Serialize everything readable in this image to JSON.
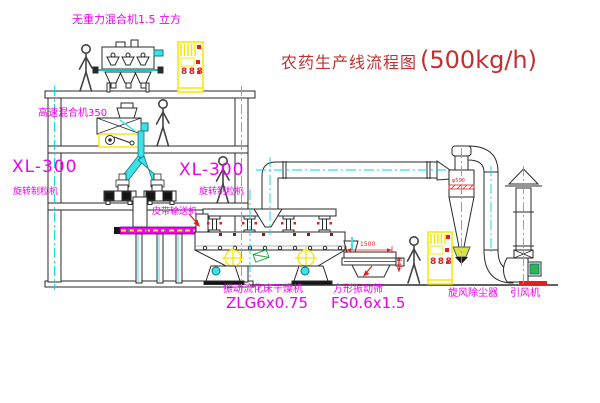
{
  "diagram": {
    "title": "农药生产线流程图",
    "capacity": "(500kg/h)"
  },
  "labels": {
    "gravity_mixer": "无重力混合机1.5 立方",
    "high_speed_mixer": "高速混合机350",
    "granulator_left_model": "XL-300",
    "granulator_left_name": "旋转制粒机",
    "granulator_mid_model": "XL-300",
    "granulator_mid_name": "旋转制粒机",
    "belt_conveyor": "皮带输送机",
    "dryer_name": "振动流化床干燥机",
    "dryer_model": "ZLG6x0.75",
    "sieve_name": "方形振动筛",
    "sieve_model": "FS0.6x1.5",
    "cyclone": "旋风除尘器",
    "fan": "引风机"
  },
  "dimensions": {
    "sieve_width": "1500",
    "sieve_height": "545",
    "cyclone_diameter": "φ500"
  },
  "cabinets": {
    "left_display": "888",
    "right_display": "888"
  },
  "colors": {
    "line": "#2a2a2a",
    "centerline_cyan": "#00d4dc",
    "pipe_cyan": "#40e0e8",
    "cabinet_yellow": "#f5e800",
    "label_magenta": "#f000f0",
    "title_red": "#c23030",
    "accent_red": "#e02020",
    "tag_green": "#22aa44"
  }
}
